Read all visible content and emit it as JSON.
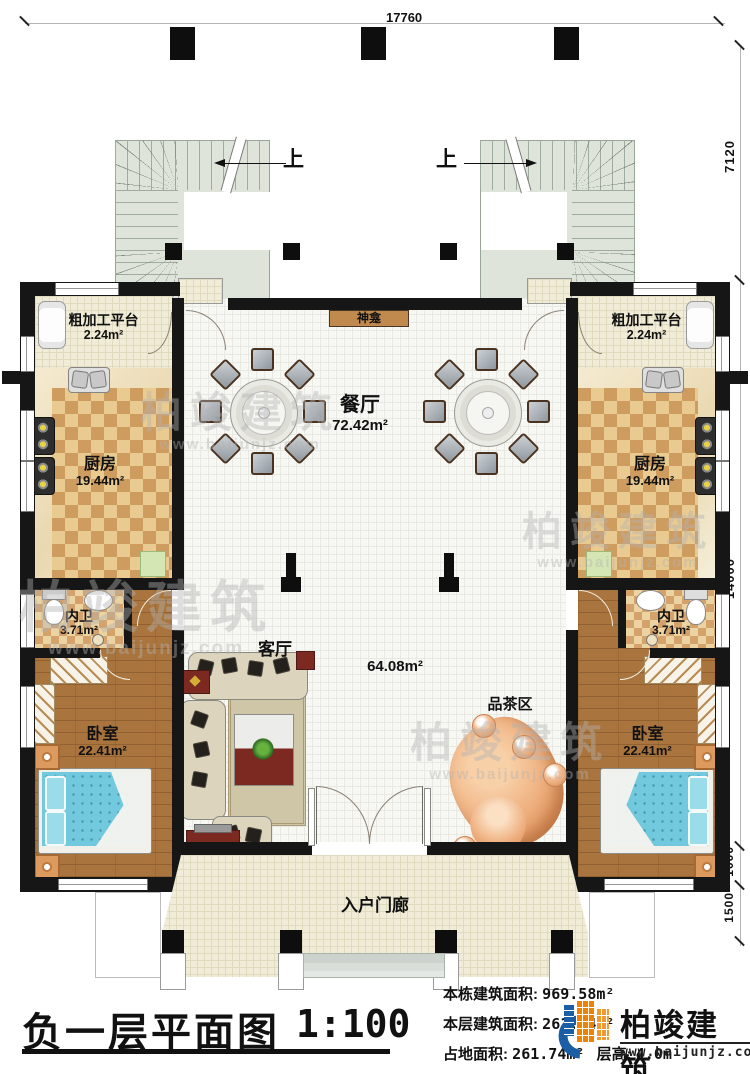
{
  "dimensions": {
    "top": "17760",
    "right_stair": "7120",
    "right_main": "14000",
    "right_porch": "1000",
    "right_steps": "1500"
  },
  "stairs": {
    "up_left": "上",
    "up_right": "上"
  },
  "rooms": {
    "shrine": {
      "name": "神龛"
    },
    "dining": {
      "name": "餐厅",
      "area": "72.42m²"
    },
    "living": {
      "name": "客厅",
      "area": "64.08m²"
    },
    "tea_area": {
      "name": "品茶区"
    },
    "porch": {
      "name": "入户门廊"
    },
    "prep_left": {
      "name": "粗加工平台",
      "area": "2.24m²"
    },
    "prep_right": {
      "name": "粗加工平台",
      "area": "2.24m²"
    },
    "kitchen_left": {
      "name": "厨房",
      "area": "19.44m²"
    },
    "kitchen_right": {
      "name": "厨房",
      "area": "19.44m²"
    },
    "bath_left": {
      "name": "内卫",
      "area": "3.71m²"
    },
    "bath_right": {
      "name": "内卫",
      "area": "3.71m²"
    },
    "bedroom_left": {
      "name": "卧室",
      "area": "22.41m²"
    },
    "bedroom_right": {
      "name": "卧室",
      "area": "22.41m²"
    }
  },
  "title_block": {
    "title": "负一层平面图",
    "scale": "1:100",
    "stats": [
      {
        "label": "本栋建筑面积:",
        "value": "969.58m²"
      },
      {
        "label": "本层建筑面积:",
        "value": "261.74m²"
      },
      {
        "label": "占地面积:",
        "value": "261.74m²",
        "label2": "层高:",
        "value2": "4.0m"
      }
    ]
  },
  "brand": {
    "name": "柏竣建筑",
    "website": "www.baijunjz.com"
  },
  "watermark": {
    "name": "柏竣建筑",
    "website": "www.baijunjz.com"
  },
  "colors": {
    "wall": "#161616",
    "stair": "#dee4da",
    "tile_a": "#e9cb92",
    "tile_b": "#cf9c60",
    "wood": "#a9743e",
    "bed": "#72c8dc",
    "porch": "#f0ecd7",
    "brand_blue": "#1b5ea6",
    "brand_orange": "#ef8200"
  }
}
